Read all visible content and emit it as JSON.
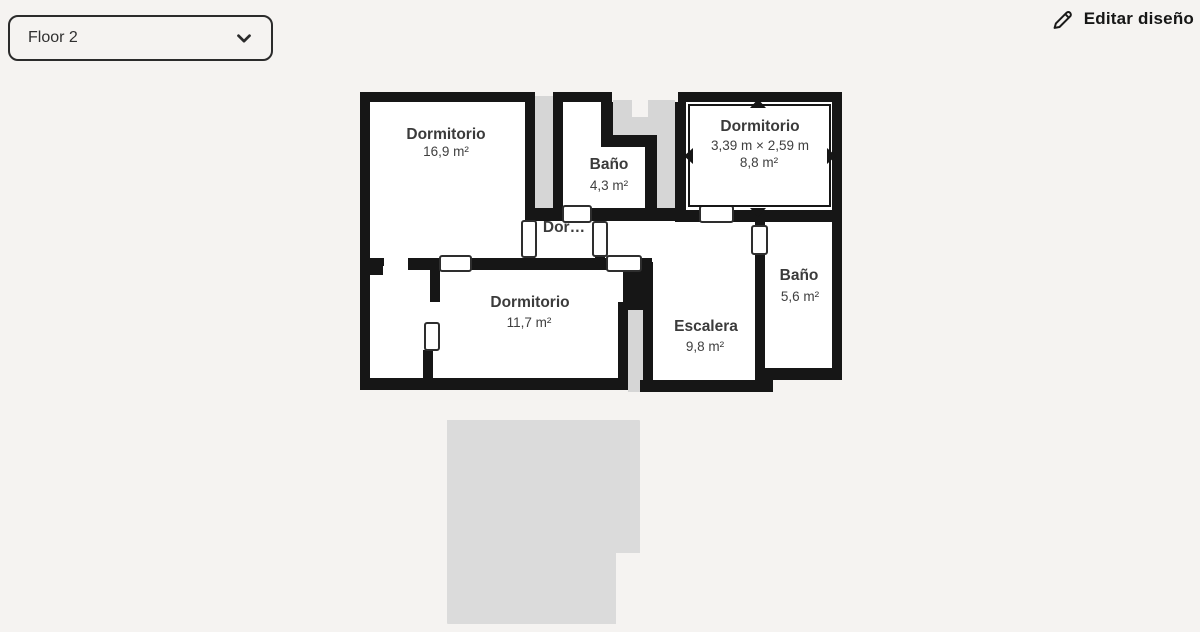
{
  "header": {
    "floor_selector": {
      "value": "Floor 2"
    },
    "edit_button": {
      "label": "Editar diseño"
    }
  },
  "floorplan": {
    "rooms": [
      {
        "name": "Dormitorio",
        "area": "16,9 m²"
      },
      {
        "name": "Baño",
        "area": "4,3 m²"
      },
      {
        "name": "Dor…"
      },
      {
        "name": "Dormitorio",
        "area": "11,7 m²"
      },
      {
        "name": "Escalera",
        "area": "9,8 m²"
      },
      {
        "name": "Baño",
        "area": "5,6 m²"
      }
    ],
    "selected_room": {
      "name": "Dormitorio",
      "dimensions": "3,39 m × 2,59 m",
      "area": "8,8 m²"
    },
    "colors": {
      "wall": "#161616",
      "underlay": "#d6d6d6",
      "background": "#f5f3f1",
      "room_fill": "#ffffff",
      "label_text": "#3b3b3b"
    }
  }
}
